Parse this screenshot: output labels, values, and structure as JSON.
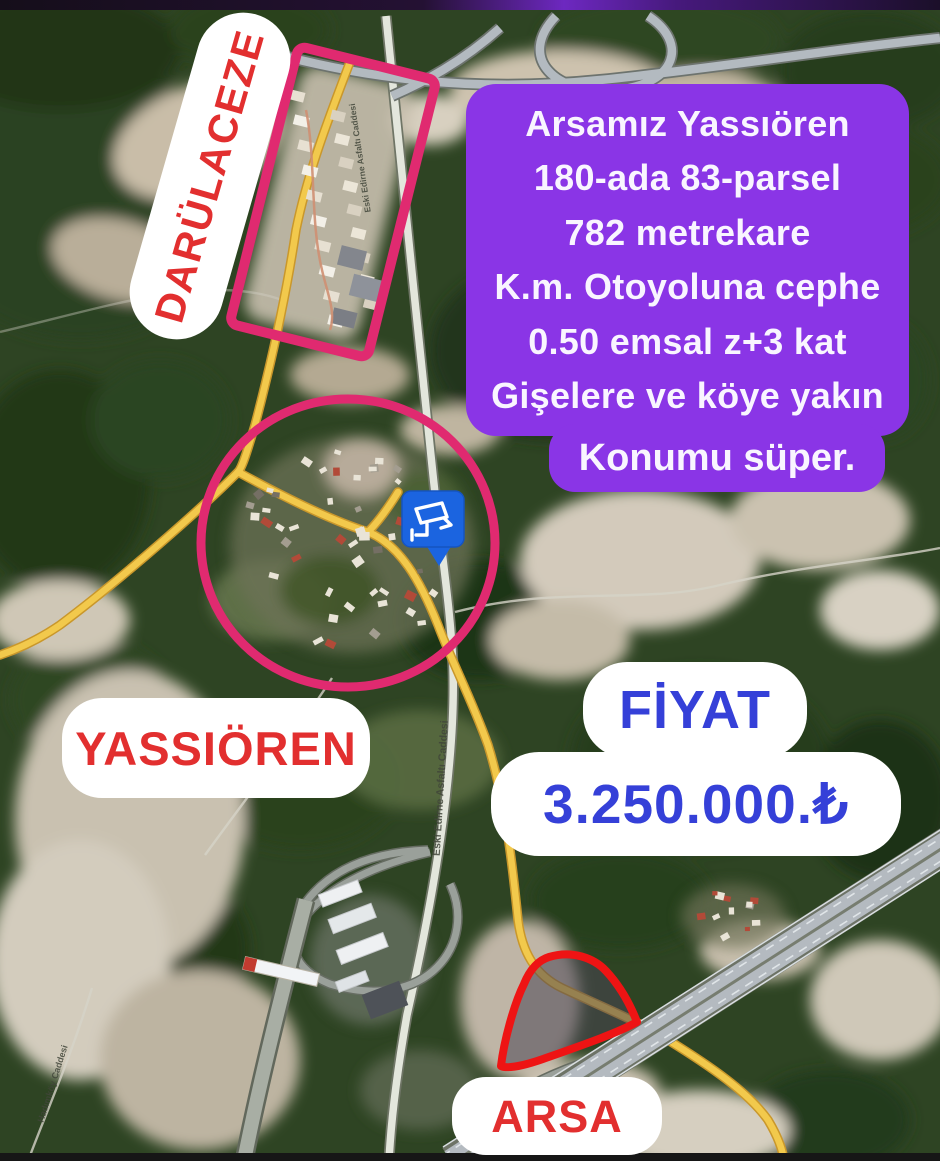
{
  "info_box": {
    "bg_color": "#8a35e6",
    "text_color": "#f9f5ff",
    "lines": [
      "Arsamız Yassıören",
      "180-ada 83-parsel",
      "782 metrekare",
      "K.m. Otoyoluna cephe",
      "0.50 emsal z+3 kat",
      "Gişelere ve köye yakın"
    ],
    "footer": "Konumu süper."
  },
  "stickers": {
    "darulaceze": {
      "label": "DARÜLACEZE",
      "text_color": "#e22f2f",
      "bg": "#ffffff"
    },
    "yassioren": {
      "label": "YASSIÖREN",
      "text_color": "#e22f2f",
      "bg": "#ffffff"
    },
    "arsa": {
      "label": "ARSA",
      "text_color": "#e22f2f",
      "bg": "#ffffff"
    },
    "fiyat": {
      "label": "FİYAT",
      "text_color": "#3540d8",
      "bg": "#ffffff"
    },
    "price": {
      "value": "3.250.000.₺",
      "text_color": "#3540d8",
      "bg": "#ffffff"
    }
  },
  "map": {
    "road_labels": {
      "eski_edirne_top": "Eski Edirne Asfaltı Caddesi",
      "eski_edirne_bottom": "Eski Edirne Asfaltı Caddesi",
      "hadimkoy": "Hadımköy Caddesi"
    },
    "marker": {
      "type": "cctv-camera-pin",
      "color": "#1b64e0"
    },
    "highlight_colors": {
      "area_outline_pink": "#e02a70",
      "parcel_outline_red": "#ee1414",
      "secondary_road_yellow": "#f2c94c"
    }
  }
}
